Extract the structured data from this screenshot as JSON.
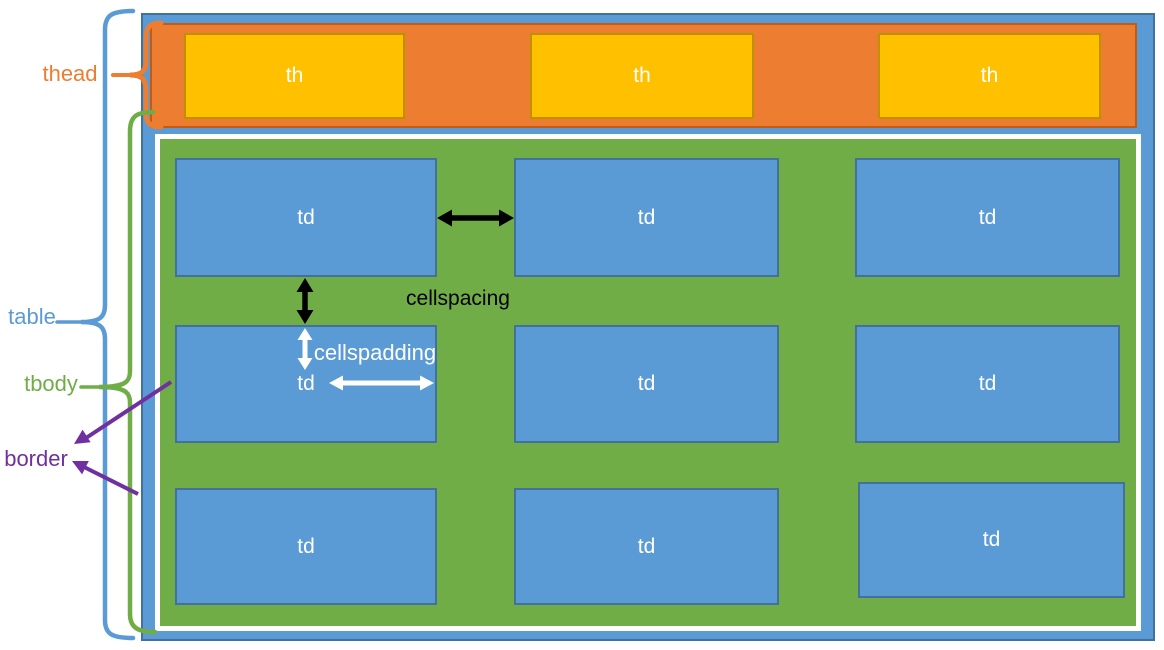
{
  "diagram_labels": {
    "thead": "thead",
    "table": "table",
    "tbody": "tbody",
    "border": "border"
  },
  "annotations": {
    "cellspacing": "cellspacing",
    "cellpadding": "cellspadding"
  },
  "table": {
    "header_cells": [
      "th",
      "th",
      "th"
    ],
    "body_rows": [
      [
        "td",
        "td",
        "td"
      ],
      [
        "td",
        "td",
        "td"
      ],
      [
        "td",
        "td",
        "td"
      ]
    ]
  },
  "colors": {
    "table_fill": "#5B9BD5",
    "table_border": "#41719C",
    "thead_fill": "#ED7D31",
    "thead_border": "#C55A11",
    "th_fill": "#FFC000",
    "th_border": "#BF9000",
    "tbody_fill": "#70AD47",
    "tbody_border": "#FFFFFF",
    "td_fill": "#5B9BD5",
    "td_border": "#41719C",
    "label_thead": "#ED7D31",
    "label_table": "#5B9BD5",
    "label_tbody": "#70AD47",
    "label_border": "#7030A0",
    "cellspacing_arrow": "#000000",
    "cellpadding_arrow": "#FFFFFF",
    "border_arrow": "#7030A0"
  }
}
